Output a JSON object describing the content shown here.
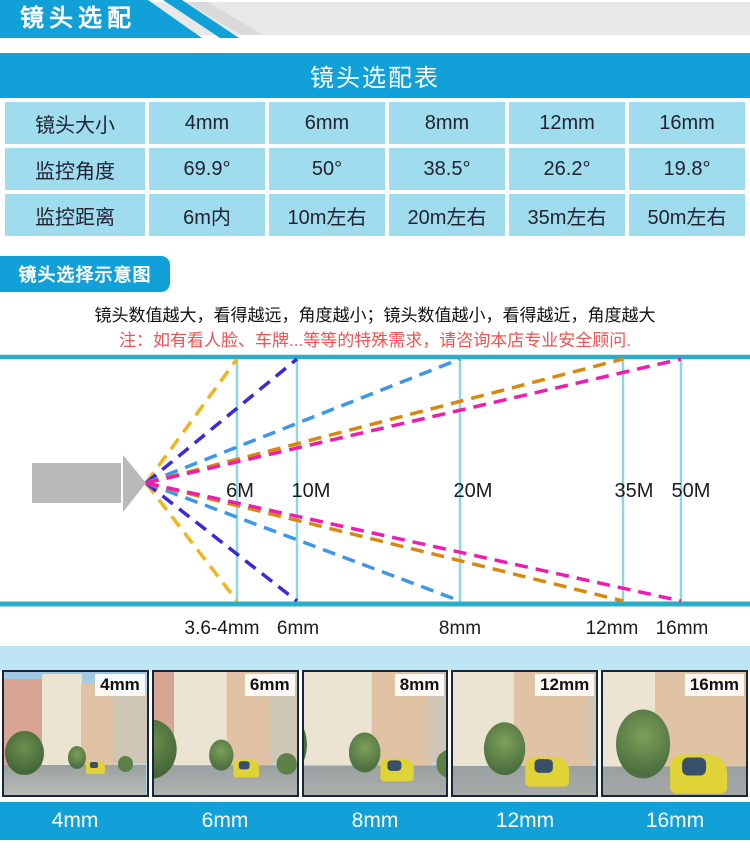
{
  "header": {
    "title": "镜头选配"
  },
  "table": {
    "title": "镜头选配表",
    "rows": [
      {
        "label": "镜头大小",
        "values": [
          "4mm",
          "6mm",
          "8mm",
          "12mm",
          "16mm"
        ]
      },
      {
        "label": "监控角度",
        "values": [
          "69.9°",
          "50°",
          "38.5°",
          "26.2°",
          "19.8°"
        ]
      },
      {
        "label": "监控距离",
        "values": [
          "6m内",
          "10m左右",
          "20m左右",
          "35m左右",
          "50m左右"
        ]
      }
    ]
  },
  "notes": {
    "section_label": "镜头选择示意图",
    "line_black": "镜头数值越大，看得越远，角度越小；镜头数值越小，看得越近，角度越大",
    "line_red": "注：如有看人脸、车牌...等等的特殊需求，请咨询本店专业安全顾问."
  },
  "diagram": {
    "distance_labels": [
      "6M",
      "10M",
      "20M",
      "35M",
      "50M"
    ],
    "lens_labels": [
      "3.6-4mm",
      "6mm",
      "8mm",
      "12mm",
      "16mm"
    ],
    "fan_lines": [
      {
        "lens": "3.6-4mm",
        "reaches": "6M",
        "color": "#f0b41e"
      },
      {
        "lens": "6mm",
        "reaches": "10M",
        "color": "#3b28d8"
      },
      {
        "lens": "8mm",
        "reaches": "20M",
        "color": "#3e97e6"
      },
      {
        "lens": "12mm",
        "reaches": "35M",
        "color": "#d8880e"
      },
      {
        "lens": "16mm",
        "reaches": "50M",
        "color": "#ee1cb0"
      }
    ]
  },
  "photos": {
    "tags": [
      "4mm",
      "6mm",
      "8mm",
      "12mm",
      "16mm"
    ],
    "bar_labels": [
      "4mm",
      "6mm",
      "8mm",
      "12mm",
      "16mm"
    ]
  },
  "colors": {
    "primary_blue": "#12a0d8",
    "table_cell_blue": "#9edcee",
    "banner_gray": "#e8e8e8",
    "diagram_border_teal": "#28aec9",
    "distance_line_teal": "#8ed7e2",
    "footer_band_blue": "#bfe5f4",
    "note_red": "#ee5252",
    "camera_gray": "#b9b9b9"
  }
}
